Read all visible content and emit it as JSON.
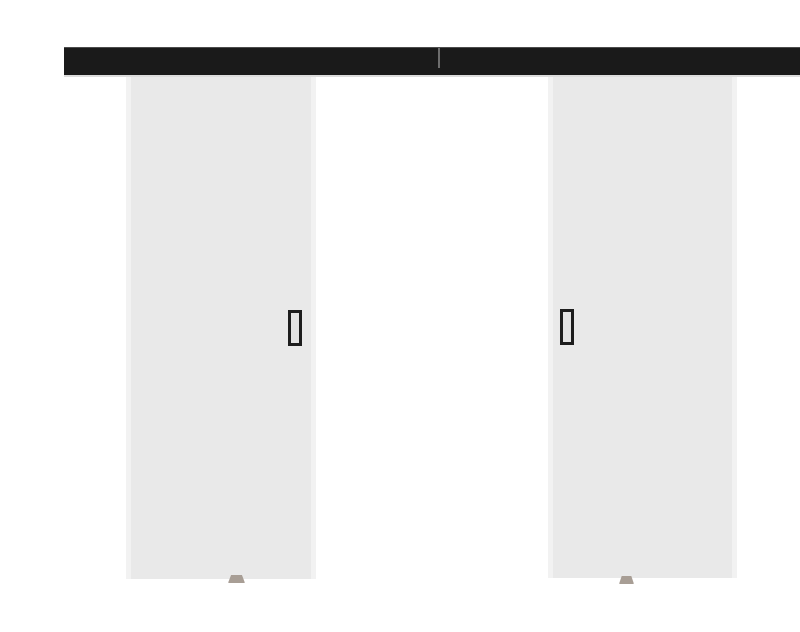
{
  "scene": {
    "type": "product-photo",
    "subject": "double sliding door system with top-mounted track",
    "background_color": "#ffffff"
  },
  "rail": {
    "name": "sliding-door-track",
    "color": "#1a1a1a",
    "top_edge_color": "#777777",
    "seam_color": "#8a8a8a",
    "under_rail_line_color": "#dcdcdc"
  },
  "left_door": {
    "name": "left-door-panel",
    "fill": "#e9e9e9",
    "edge_highlight": "#f3f3f3"
  },
  "right_door": {
    "name": "right-door-panel",
    "fill": "#e9e9e9",
    "edge_highlight": "#f3f3f3"
  },
  "handles": {
    "frame_color": "#1d1d1d",
    "inner_color": "#e3e3e3"
  },
  "floor_guides": {
    "color": "#a89e95"
  }
}
